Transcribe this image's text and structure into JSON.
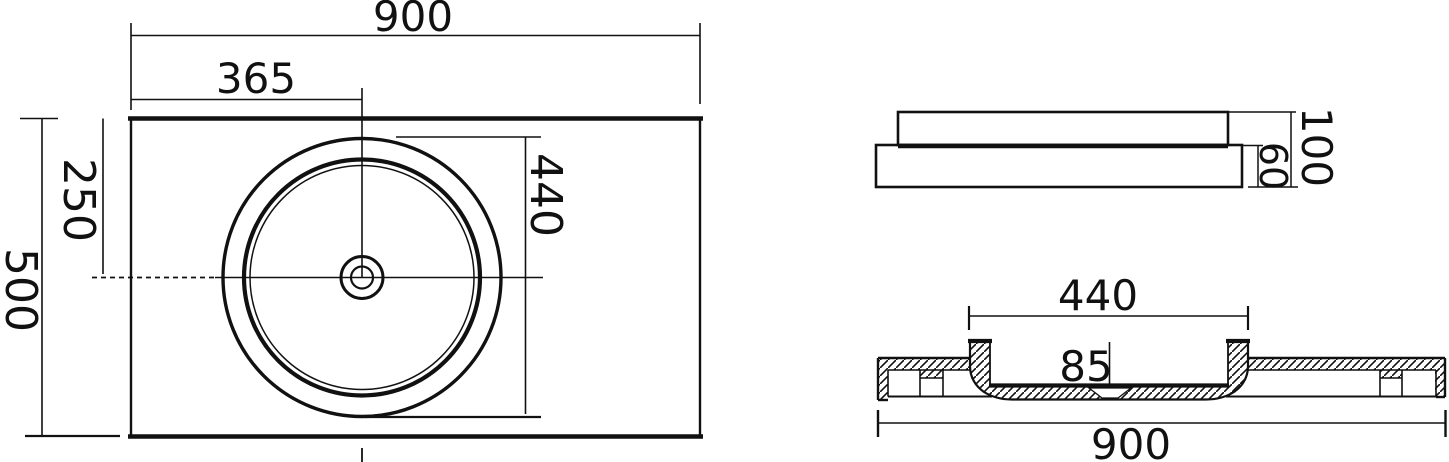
{
  "drawing": {
    "type": "technical-dimension-drawing",
    "subject": "countertop washbasin",
    "colors": {
      "line": "#111111",
      "background": "#ffffff"
    },
    "views": {
      "plan": {
        "name": "plan view",
        "dims": {
          "total_width": "900",
          "center_offset_x": "365",
          "center_offset_y": "250",
          "total_depth": "500",
          "bowl_diameter": "440"
        }
      },
      "side": {
        "name": "side elevation",
        "dims": {
          "base_height": "60",
          "total_height": "100"
        }
      },
      "section": {
        "name": "cross section",
        "dims": {
          "bowl_width": "440",
          "bowl_depth": "85",
          "total_width": "900"
        }
      }
    }
  }
}
